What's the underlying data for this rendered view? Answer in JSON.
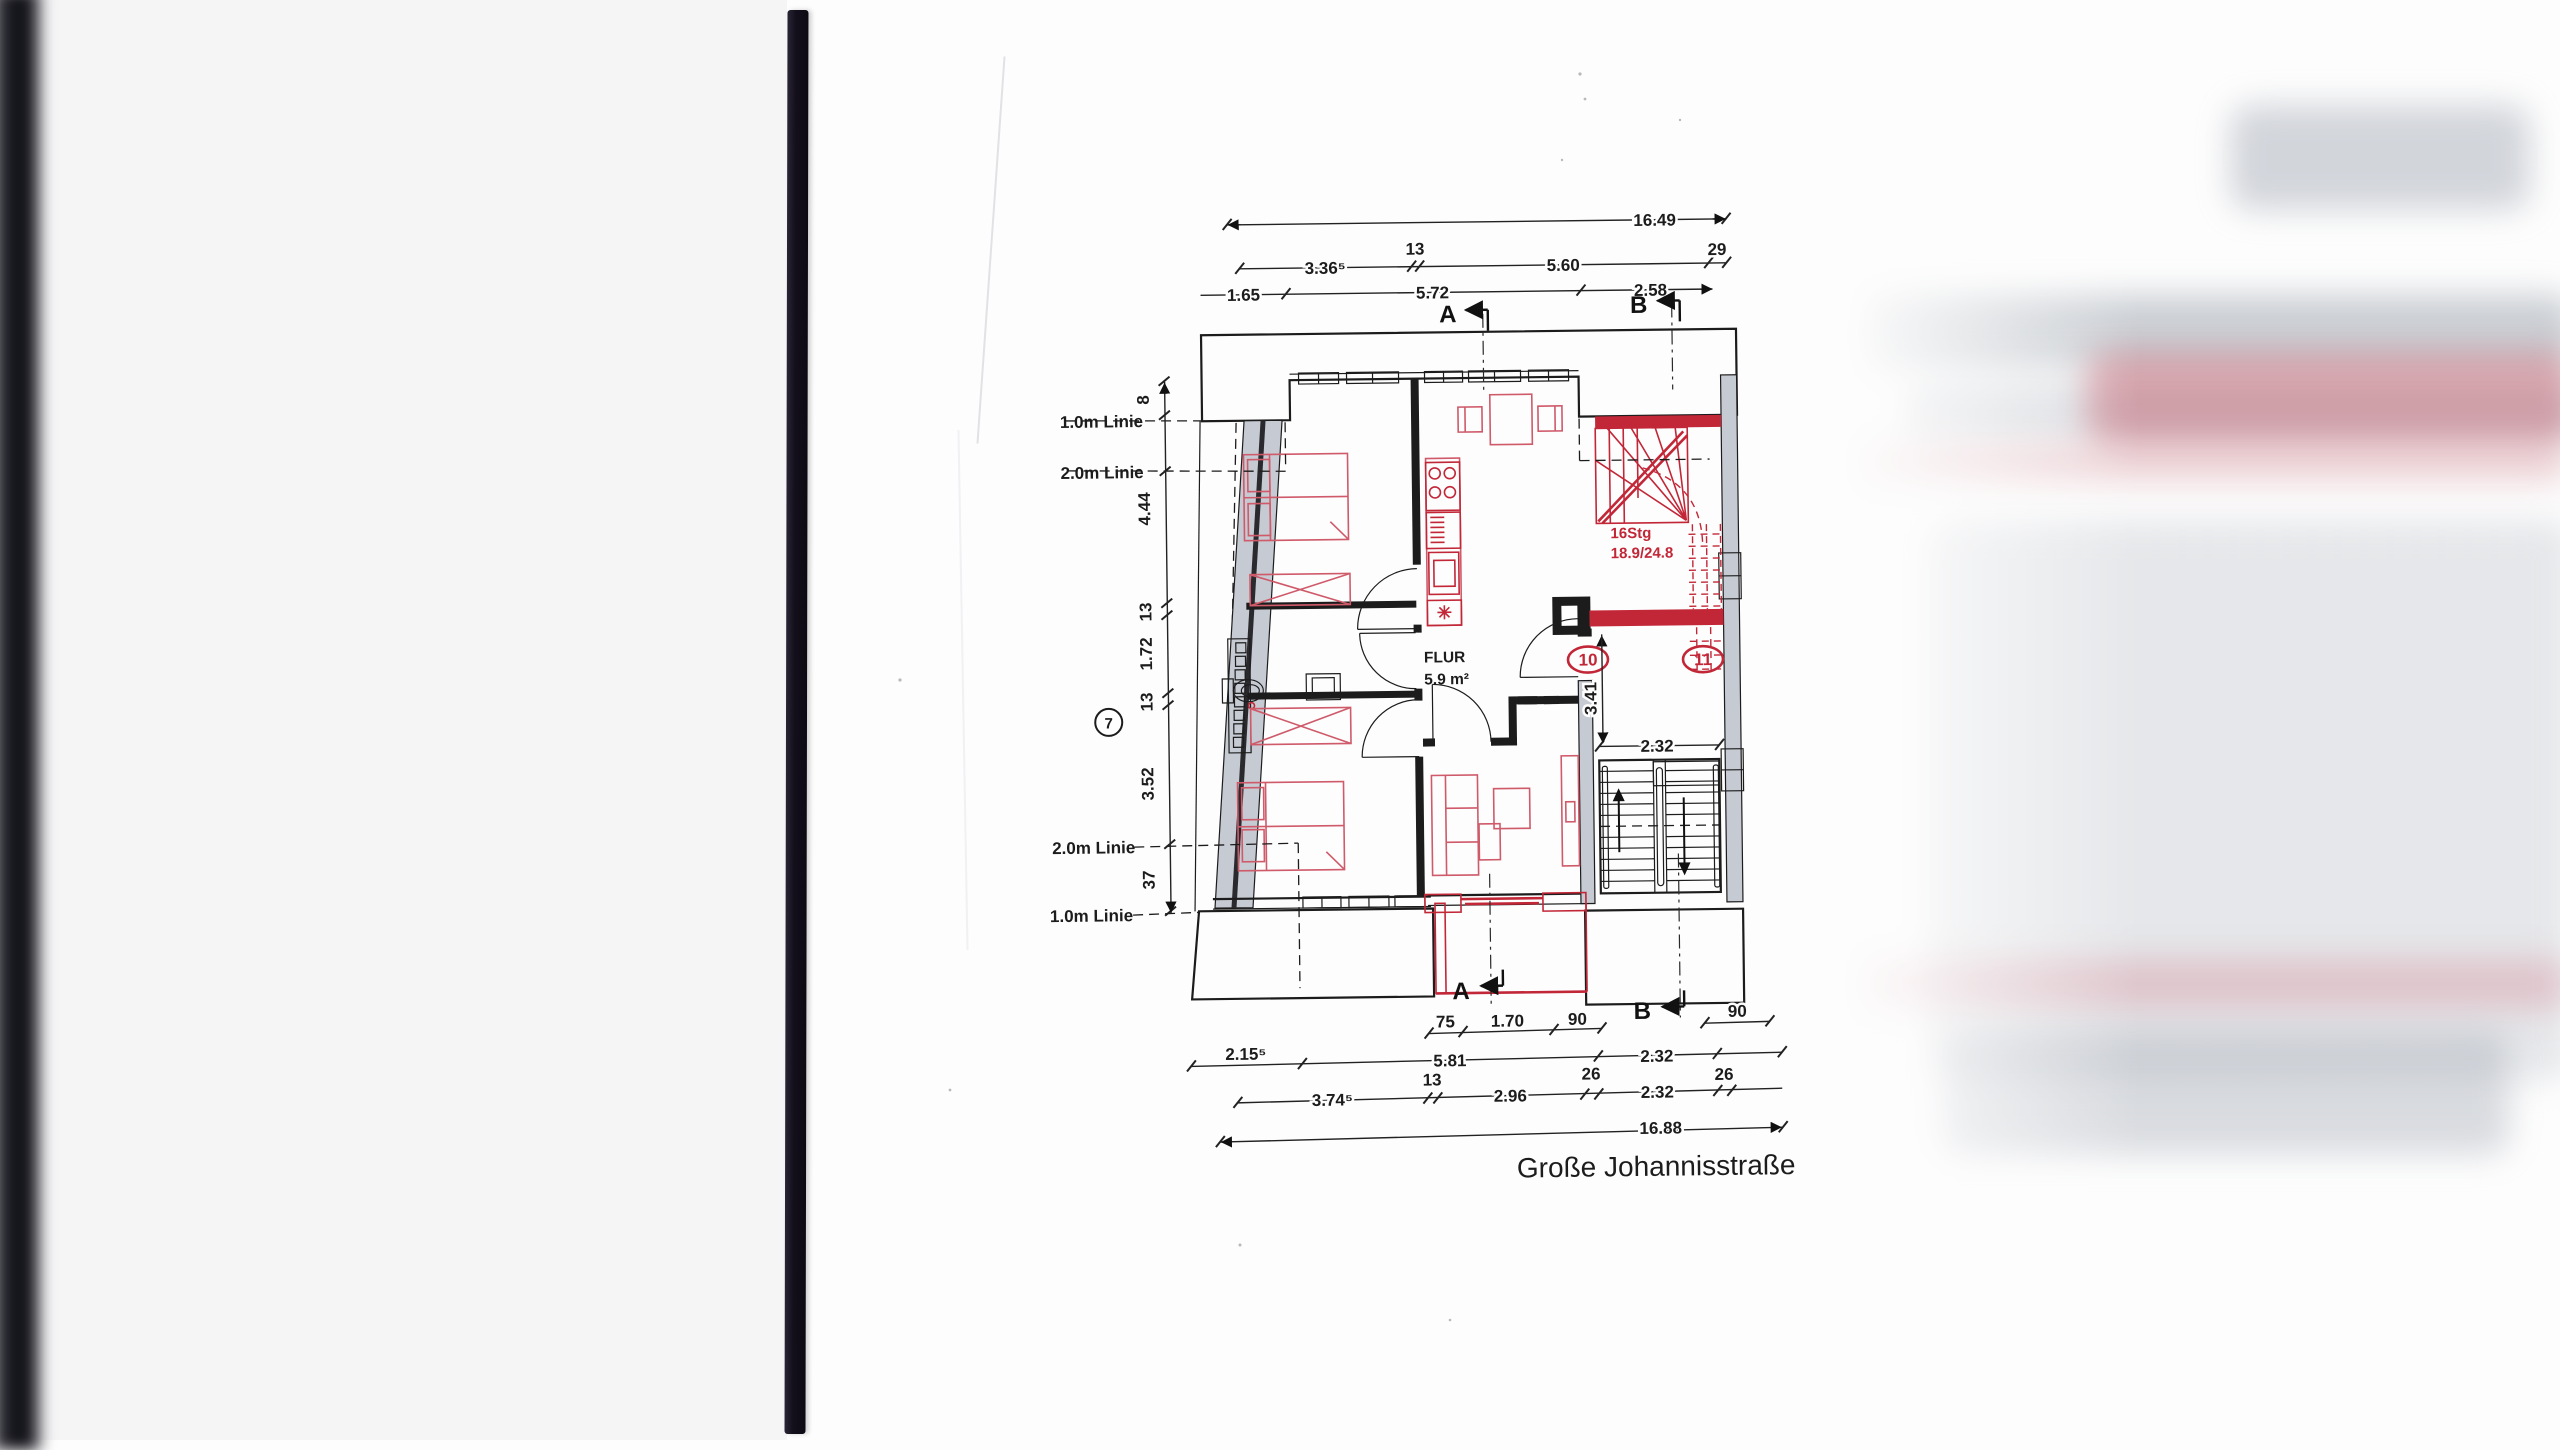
{
  "document": {
    "street_label": "Große Johannisstraße"
  },
  "colors": {
    "ink": "#1c1c1c",
    "red": "#c22738",
    "redsoft": "#cf5a6a",
    "wall": "#c6cad2",
    "paper": "#fdfdfd",
    "bar": "#17131e"
  },
  "plan": {
    "rooms": {
      "flur_name": "FLUR",
      "flur_area": "5.9 m²"
    },
    "stairs": {
      "count_note": "16Stg",
      "ratio_note": "18.9/24.8"
    },
    "markers": {
      "section_a_top": "A",
      "section_b_top": "B",
      "section_a_bottom": "A",
      "section_b_bottom": "B",
      "pos7": "7",
      "unit10": "10",
      "unit11": "11"
    },
    "guide_lines": {
      "top_1m": "1.0m Linie",
      "top_2m": "2.0m Linie",
      "bottom_2m": "2.0m Linie",
      "bottom_1m": "1.0m Linie"
    },
    "dims_top": {
      "total": "16.49",
      "row2": [
        "3.36⁵",
        "13",
        "5.60",
        "29"
      ],
      "row3": [
        "1.65",
        "5.72",
        "2.58"
      ]
    },
    "dims_left": [
      "8",
      "4.44",
      "13",
      "1.72",
      "13",
      "3.52",
      "37"
    ],
    "dims_bottom": {
      "row1": [
        "75",
        "1.70",
        "90"
      ],
      "row1_right": "90",
      "row2": [
        "2.15⁵",
        "5.81",
        "2.32"
      ],
      "row3": [
        "3.74⁵",
        "13",
        "2.96",
        "26",
        "2.32",
        "26"
      ],
      "total": "16.88"
    },
    "dims_inner": {
      "stair_width": "2.32",
      "hall_depth": "3.41"
    }
  }
}
